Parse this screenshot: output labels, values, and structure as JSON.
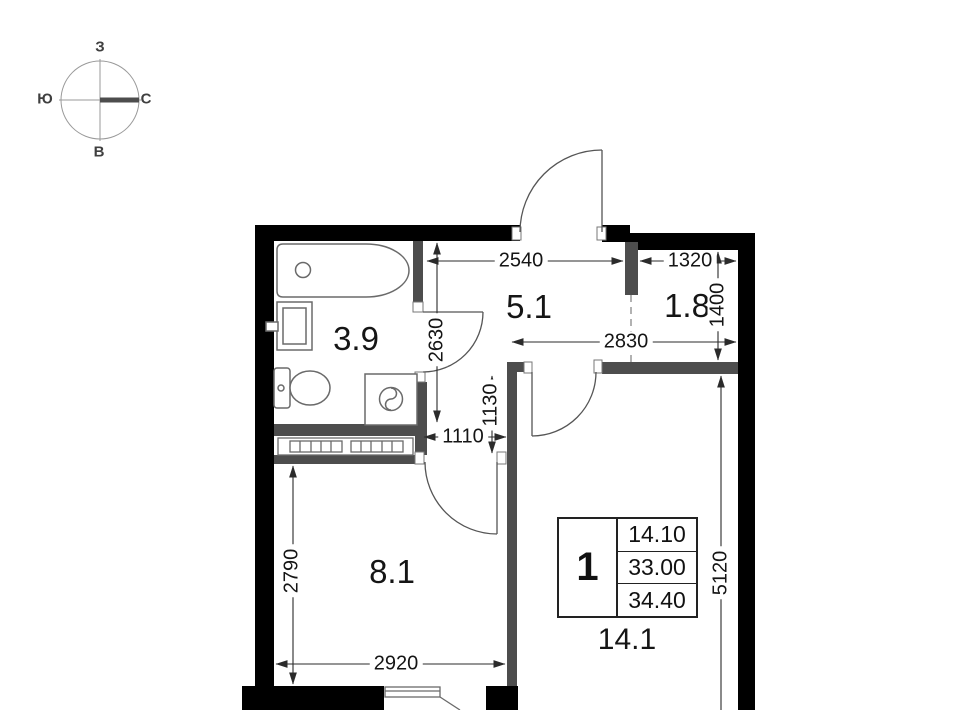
{
  "compass": {
    "west": "З",
    "south": "Ю",
    "north": "С",
    "east": "В"
  },
  "rooms": {
    "bathroom_area": "3.9",
    "hallway_area": "5.1",
    "storage_area": "1.8",
    "kitchen_area": "8.1",
    "living_room_area": "14.1"
  },
  "dimensions": {
    "d2540": "2540",
    "d1320": "1320",
    "d1400": "1400",
    "d2830": "2830",
    "d2630": "2630",
    "d1130": "1130",
    "d1110": "1110",
    "d2790": "2790",
    "d2920": "2920",
    "d5120": "5120"
  },
  "info_table": {
    "rooms_count": "1",
    "living_area": "14.10",
    "area_without_balcony": "33.00",
    "total_area": "34.40"
  },
  "colors": {
    "outer_wall": "#000000",
    "partition_wall": "#4d4d4d",
    "drawing_line": "#2b2b2b",
    "fixture_line": "#6a6a6a"
  }
}
